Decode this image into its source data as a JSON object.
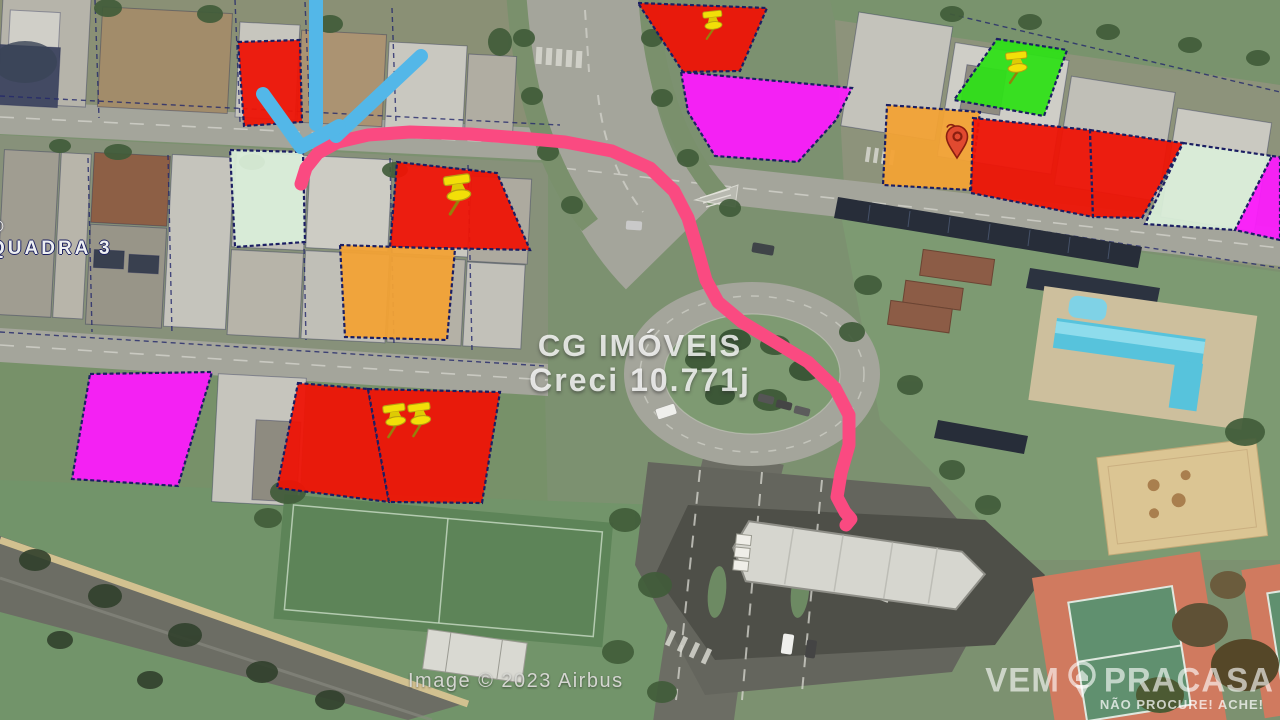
{
  "texts": {
    "watermark_line1": "CG IMÓVEIS",
    "watermark_line2": "Creci 10.771j",
    "block_label": "QUADRA 3",
    "block_label_symbol": "©",
    "attribution": "Image © 2023 Airbus",
    "logo_word1": "VEM",
    "logo_word2": "PRACASA",
    "logo_tagline": "NÃO PROCURE! ACHE!"
  },
  "map": {
    "colors": {
      "lot_red": "#ee1406",
      "lot_magenta": "#fb1bfb",
      "lot_orange": "#f2a235",
      "lot_green": "#2fdf18",
      "lot_mint": "#d9edd8",
      "lot_border": "#1b1e63",
      "route_pink": "#fa4a81",
      "arrow_blue": "#53b7e8",
      "pushpin_yellow": "#f2df08",
      "redpin_red": "#e14a30"
    },
    "lots": [
      {
        "id": "lot-1",
        "color": "red",
        "points": "238,42 300,40 302,122 244,126"
      },
      {
        "id": "lot-2",
        "color": "mint",
        "points": "230,150 303,152 305,242 235,247"
      },
      {
        "id": "lot-3",
        "color": "red",
        "points": "397,162 497,173 530,250 390,247",
        "marker": {
          "type": "pushpin",
          "x": 458,
          "y": 189,
          "scale": 1.25,
          "rotate": -8
        }
      },
      {
        "id": "lot-4",
        "color": "orange",
        "points": "340,245 455,249 447,340 345,337"
      },
      {
        "id": "lot-5",
        "color": "magenta",
        "points": "90,374 212,372 178,486 72,479"
      },
      {
        "id": "lot-6",
        "color": "red",
        "points": "298,383 368,389 389,502 277,488",
        "marker": {
          "type": "pushpin",
          "x": 395,
          "y": 416,
          "scale": 1.05,
          "rotate": -8
        }
      },
      {
        "id": "lot-7",
        "color": "red",
        "points": "368,389 500,392 482,503 389,502",
        "marker": {
          "type": "pushpin",
          "x": 420,
          "y": 415,
          "scale": 1.05,
          "rotate": -8
        }
      },
      {
        "id": "lot-8",
        "color": "red",
        "points": "638,3 767,8 740,71 683,72",
        "marker": {
          "type": "pushpin",
          "x": 713,
          "y": 21,
          "scale": 0.9,
          "rotate": -6
        }
      },
      {
        "id": "lot-9",
        "color": "magenta",
        "points": "681,72 852,88 836,120 798,162 715,156 688,112"
      },
      {
        "id": "lot-10",
        "color": "green",
        "points": "997,39 1067,50 1044,116 954,100",
        "marker": {
          "type": "pushpin",
          "x": 1017,
          "y": 63,
          "scale": 1.0,
          "rotate": -6
        }
      },
      {
        "id": "lot-11",
        "color": "orange",
        "points": "887,105 980,112 970,190 883,185",
        "marker": {
          "type": "redpin",
          "x": 957,
          "y": 141,
          "scale": 1.0,
          "rotate": 0
        }
      },
      {
        "id": "lot-12",
        "color": "red",
        "points": "973,118 1090,130 1093,217 971,193"
      },
      {
        "id": "lot-13",
        "color": "red",
        "points": "1090,130 1183,143 1142,218 1093,217"
      },
      {
        "id": "lot-14",
        "color": "mint",
        "points": "1183,143 1272,156 1235,230 1145,224"
      },
      {
        "id": "lot-15",
        "color": "magenta",
        "points": "1272,156 1280,157 1280,240 1235,230"
      }
    ],
    "route": {
      "width": 13,
      "points": "301,184 306,168 318,153 338,142 368,135 410,132 470,134 520,138 565,142 612,151 650,168 674,191 688,218 697,248 706,280 718,302 742,322 775,342 808,362 835,388 849,415 849,445 841,473 837,497 845,512 851,519 846,525"
    },
    "arrow": {
      "width": 14,
      "strokes": [
        "316,-8 316,124",
        "421,56 336,136",
        "263,94 301,147 339,126"
      ]
    }
  }
}
